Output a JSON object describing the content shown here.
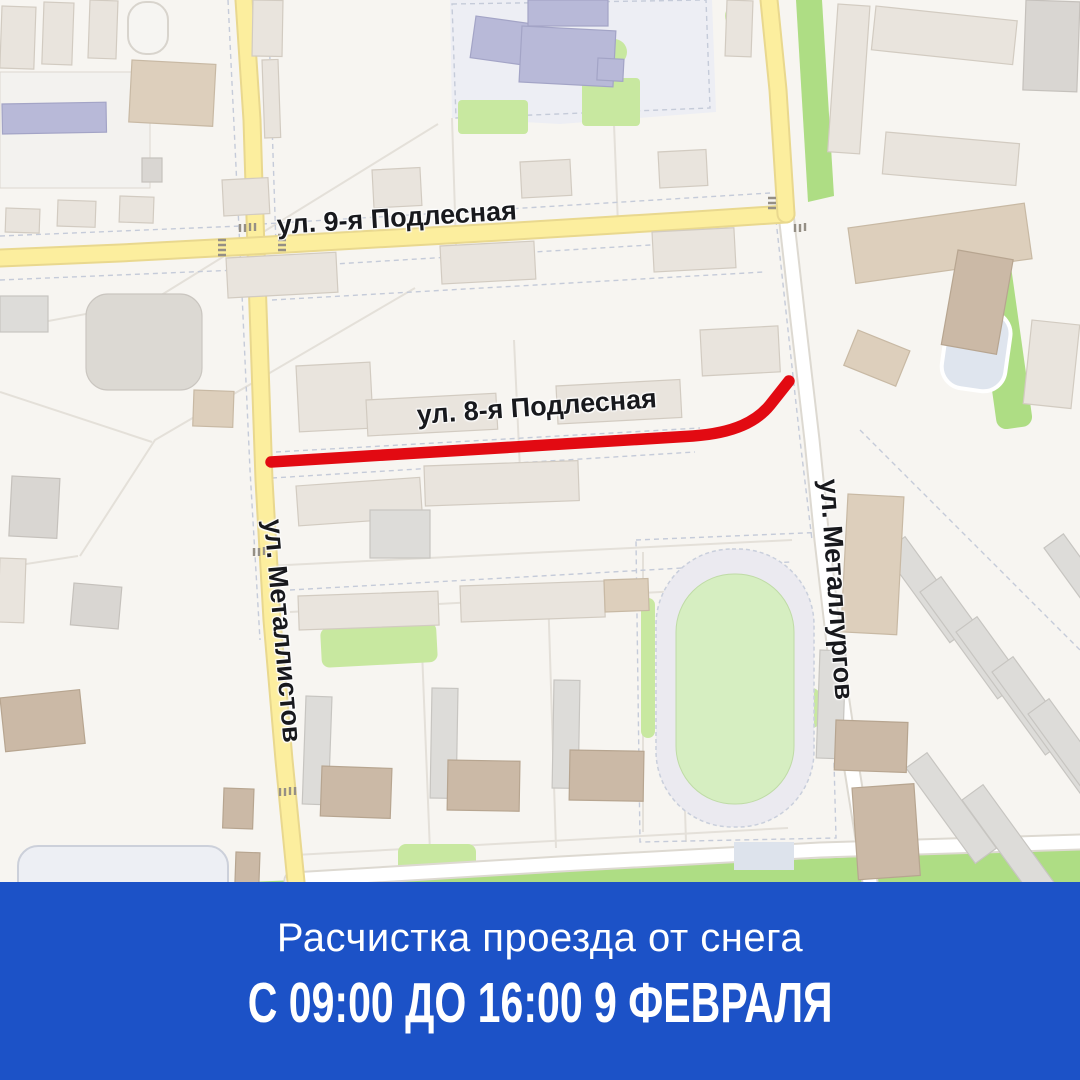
{
  "map": {
    "street_labels": [
      {
        "id": "podlesnaya9",
        "text": "ул. 9-я Подлесная"
      },
      {
        "id": "podlesnaya8",
        "text": "ул. 8-я Подлесная"
      },
      {
        "id": "metallistov",
        "text": "ул. Металлистов"
      },
      {
        "id": "metallurgov",
        "text": "ул. Металлургов"
      }
    ],
    "highlighted_street": "ул. 8-я Подлесная"
  },
  "banner": {
    "line1": "Расчистка проезда от снега",
    "line2": "С 09:00 ДО 16:00 9 ФЕВРАЛЯ"
  },
  "theme": {
    "banner_bg": "#1c52c7",
    "banner_text": "#ffffff",
    "highlight_red": "#e20a12",
    "road_yellow": "#fcee9e",
    "road_yellow_border": "#e9d88e",
    "road_white": "#ffffff",
    "road_casing": "#ddd9d1",
    "map_bg": "#f7f5f1",
    "label_color": "#18191d"
  }
}
